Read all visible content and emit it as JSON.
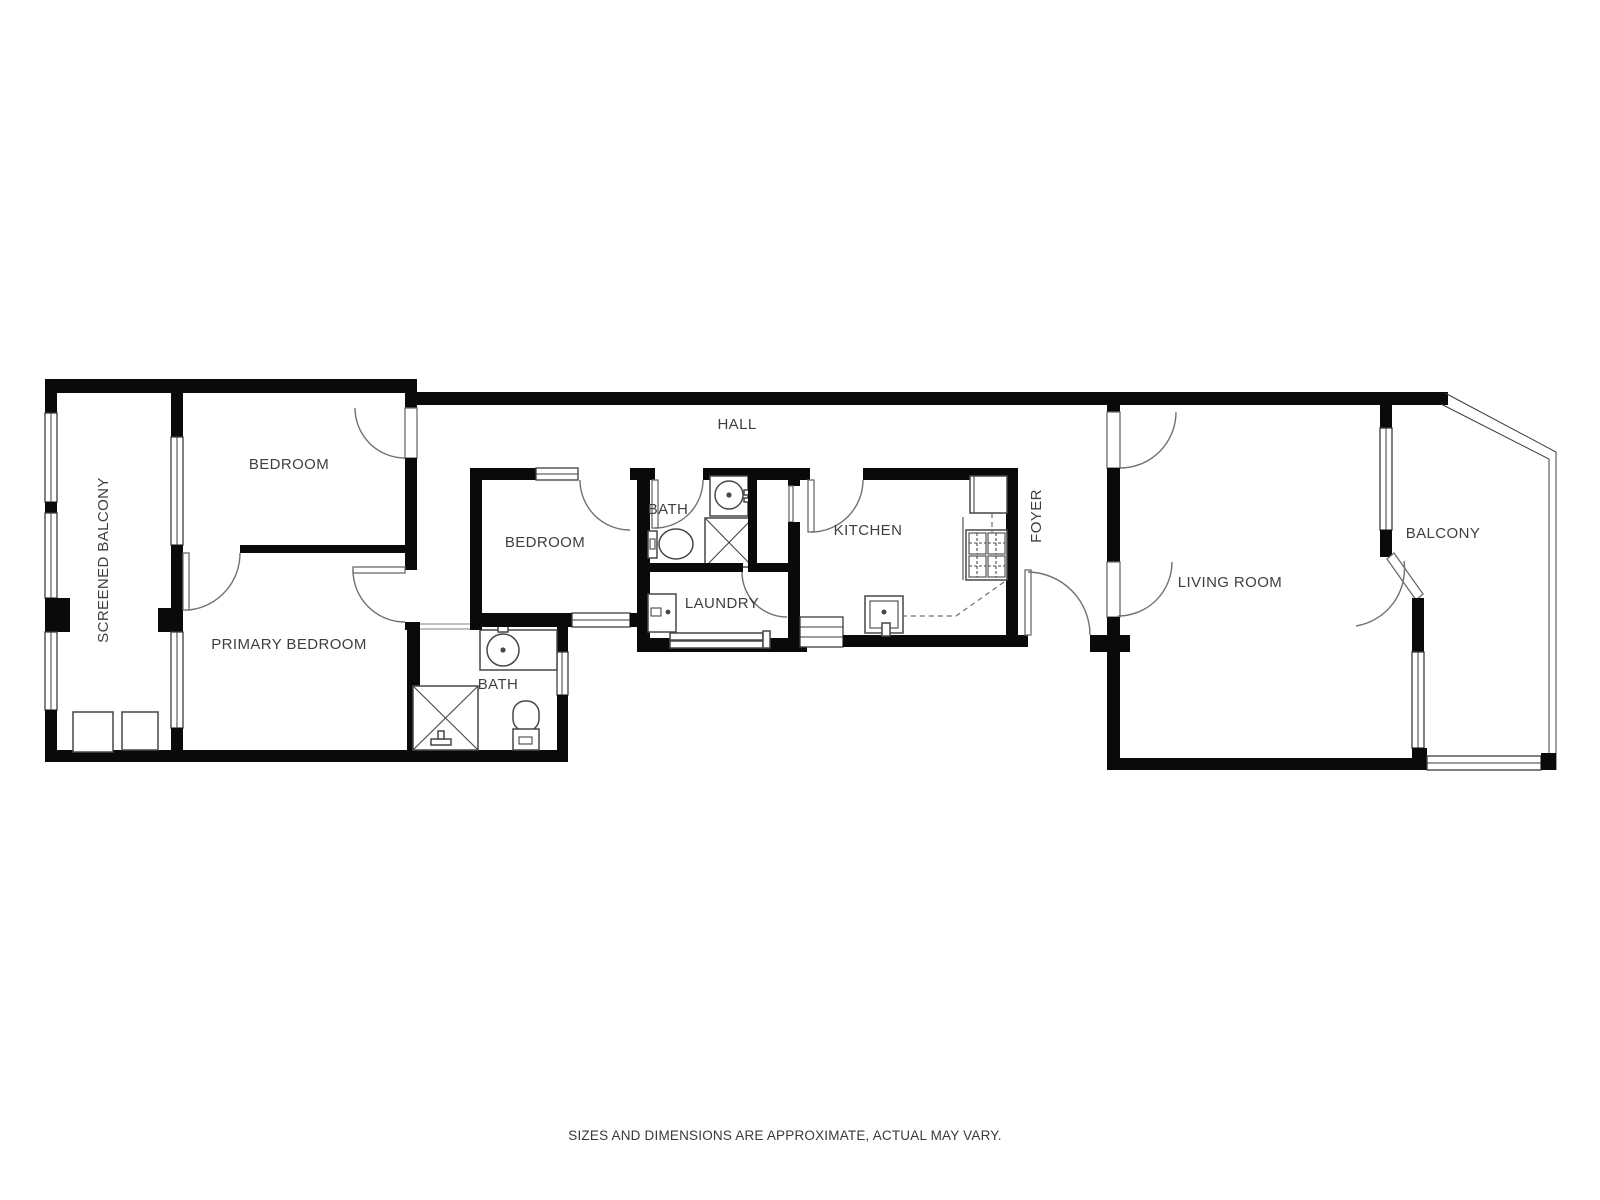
{
  "rooms": {
    "screened_balcony": "SCREENED BALCONY",
    "bedroom_top": "BEDROOM",
    "primary_bedroom": "PRIMARY BEDROOM",
    "bedroom_middle": "BEDROOM",
    "bath_upper": "BATH",
    "bath_lower": "BATH",
    "laundry": "LAUNDRY",
    "kitchen": "KITCHEN",
    "hall": "HALL",
    "foyer": "FOYER",
    "living_room": "LIVING ROOM",
    "balcony": "BALCONY"
  },
  "footer": {
    "disclaimer": "SIZES AND DIMENSIONS ARE APPROXIMATE, ACTUAL MAY VARY."
  },
  "colors": {
    "wall": "#0a0a0a",
    "line": "#3d3d3d",
    "label": "#3f3f3f"
  }
}
